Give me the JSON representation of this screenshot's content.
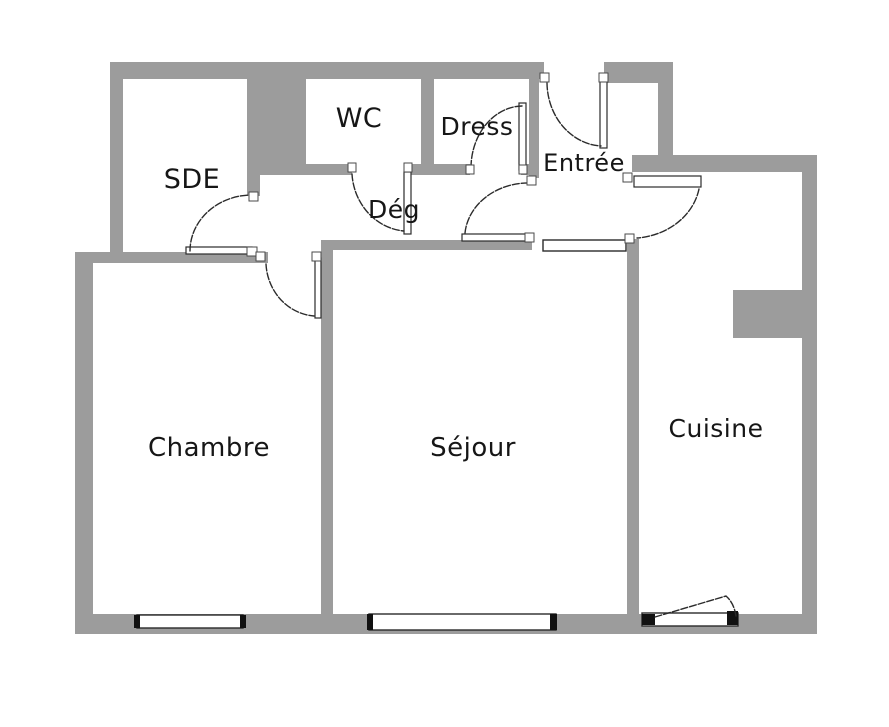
{
  "canvas": {
    "width": 889,
    "height": 727,
    "background": "#ffffff"
  },
  "colors": {
    "wall": "#9c9c9c",
    "line": "#2b2b2b",
    "label": "#161616",
    "fill": "#ffffff",
    "cap": "#111111"
  },
  "rooms": [
    {
      "id": "sde",
      "label": "SDE",
      "x": 192,
      "y": 188,
      "font": 27
    },
    {
      "id": "wc",
      "label": "WC",
      "x": 359,
      "y": 127,
      "font": 27
    },
    {
      "id": "dress",
      "label": "Dress",
      "x": 477,
      "y": 135,
      "font": 25
    },
    {
      "id": "deg",
      "label": "Dég",
      "x": 394,
      "y": 218,
      "font": 25
    },
    {
      "id": "entree",
      "label": "Entrée",
      "x": 584,
      "y": 171,
      "font": 24
    },
    {
      "id": "chambre",
      "label": "Chambre",
      "x": 209,
      "y": 456,
      "font": 26
    },
    {
      "id": "sejour",
      "label": "Séjour",
      "x": 473,
      "y": 456,
      "font": 26
    },
    {
      "id": "cuisine",
      "label": "Cuisine",
      "x": 716,
      "y": 437,
      "font": 25
    }
  ],
  "walls": [
    {
      "id": "top-left",
      "r": [
        110,
        62,
        434,
        17
      ]
    },
    {
      "id": "top-right",
      "r": [
        604,
        62,
        69,
        21
      ]
    },
    {
      "id": "sde-left",
      "r": [
        110,
        62,
        13,
        191
      ]
    },
    {
      "id": "sde-wc-mass",
      "r": [
        247,
        62,
        59,
        106
      ]
    },
    {
      "id": "sde-right",
      "r": [
        247,
        160,
        13,
        36
      ]
    },
    {
      "id": "wc-bottom",
      "r": [
        247,
        164,
        105,
        11
      ]
    },
    {
      "id": "wc-bottom-right",
      "r": [
        407,
        164,
        27,
        11
      ]
    },
    {
      "id": "wc-dress-divider",
      "r": [
        421,
        70,
        13,
        94
      ]
    },
    {
      "id": "dress-bottom",
      "r": [
        426,
        164,
        44,
        11
      ]
    },
    {
      "id": "dress-bottom-stub",
      "r": [
        521,
        164,
        17,
        11
      ]
    },
    {
      "id": "dress-entree-divider",
      "r": [
        529,
        70,
        10,
        108
      ]
    },
    {
      "id": "entree-right",
      "r": [
        658,
        62,
        15,
        104
      ]
    },
    {
      "id": "cuisine-top",
      "r": [
        632,
        155,
        185,
        17
      ]
    },
    {
      "id": "outer-right",
      "r": [
        802,
        155,
        15,
        479
      ]
    },
    {
      "id": "cuisine-notch",
      "r": [
        733,
        290,
        69,
        48
      ]
    },
    {
      "id": "sejour-cuisine-divider",
      "r": [
        627,
        239,
        12,
        380
      ]
    },
    {
      "id": "sejour-top",
      "r": [
        322,
        240,
        210,
        10
      ]
    },
    {
      "id": "chambre-sejour-divider",
      "r": [
        321,
        240,
        12,
        379
      ]
    },
    {
      "id": "chambre-top",
      "r": [
        75,
        252,
        193,
        11
      ]
    },
    {
      "id": "outer-left",
      "r": [
        75,
        252,
        18,
        382
      ]
    },
    {
      "id": "bottom",
      "r": [
        75,
        614,
        742,
        20
      ]
    }
  ],
  "windows": [
    {
      "id": "chambre-window",
      "r": [
        137,
        615,
        106,
        13
      ],
      "caps": [
        [
          134,
          615,
          6,
          13
        ],
        [
          240,
          615,
          6,
          13
        ]
      ]
    },
    {
      "id": "sejour-window",
      "r": [
        369,
        614,
        187,
        16
      ],
      "caps": [
        [
          367,
          614,
          6,
          16
        ],
        [
          550,
          614,
          7,
          16
        ]
      ]
    },
    {
      "id": "cuisine-balcony-window",
      "r": [
        642,
        613,
        96,
        13
      ],
      "caps": [
        [
          642,
          614,
          13,
          11
        ],
        [
          727,
          611,
          11,
          14
        ]
      ]
    },
    {
      "id": "entree-sejour-window",
      "r": [
        543,
        240,
        83,
        11
      ],
      "caps": []
    }
  ],
  "doors": [
    {
      "id": "sde-door",
      "leaf": [
        186,
        247,
        66,
        7
      ],
      "arc": "M 190 251 A 62 56 0 0 1 252 195"
    },
    {
      "id": "wc-door",
      "leaf": [
        404,
        172,
        7,
        62
      ],
      "arc": "M 352 174 A 57 61 0 0 0 404 231"
    },
    {
      "id": "dress-door",
      "leaf": [
        519,
        103,
        7,
        67
      ],
      "arc": "M 522 106 A 52 62 0 0 0 471 169"
    },
    {
      "id": "entrance-door",
      "leaf": [
        600,
        80,
        7,
        68
      ],
      "arc": "M 547 83 A 57 64 0 0 0 601 146"
    },
    {
      "id": "deg-entree-door",
      "leaf": [
        462,
        234,
        68,
        7
      ],
      "arc": "M 465 233 A 64 55 0 0 1 532 183"
    },
    {
      "id": "entree-cuisine-door",
      "leaf": [
        634,
        176,
        67,
        11
      ],
      "arc": "M 699 189 A 69 60 0 0 1 637 238"
    },
    {
      "id": "chambre-door",
      "leaf": [
        315,
        258,
        6,
        60
      ],
      "arc": "M 266 264 A 52 55 0 0 0 314 316"
    },
    {
      "id": "balcony-door-swing",
      "arc": "M 655 617 L 726 596 Q 734 603 736 616"
    }
  ],
  "markers": [
    {
      "id": "sde-door-top-jamb",
      "r": [
        249,
        192,
        9,
        9
      ]
    },
    {
      "id": "sde-door-hinge",
      "r": [
        247,
        247,
        10,
        9
      ]
    },
    {
      "id": "wc-door-jamb",
      "r": [
        348,
        163,
        8,
        9
      ]
    },
    {
      "id": "wc-door-hinge",
      "r": [
        404,
        163,
        8,
        9
      ]
    },
    {
      "id": "dress-door-jamb",
      "r": [
        466,
        165,
        8,
        9
      ]
    },
    {
      "id": "dress-door-hinge",
      "r": [
        519,
        165,
        8,
        9
      ]
    },
    {
      "id": "deg-door-top-jamb",
      "r": [
        527,
        176,
        9,
        9
      ]
    },
    {
      "id": "deg-door-hinge",
      "r": [
        525,
        233,
        9,
        9
      ]
    },
    {
      "id": "entrance-door-jamb",
      "r": [
        540,
        73,
        9,
        9
      ]
    },
    {
      "id": "entrance-door-hinge",
      "r": [
        599,
        73,
        9,
        9
      ]
    },
    {
      "id": "cuisine-door-hinge",
      "r": [
        623,
        173,
        9,
        9
      ]
    },
    {
      "id": "cuisine-door-jamb",
      "r": [
        625,
        234,
        9,
        9
      ]
    },
    {
      "id": "chambre-door-jamb",
      "r": [
        256,
        252,
        9,
        9
      ]
    },
    {
      "id": "chambre-door-hinge",
      "r": [
        312,
        252,
        9,
        9
      ]
    }
  ]
}
